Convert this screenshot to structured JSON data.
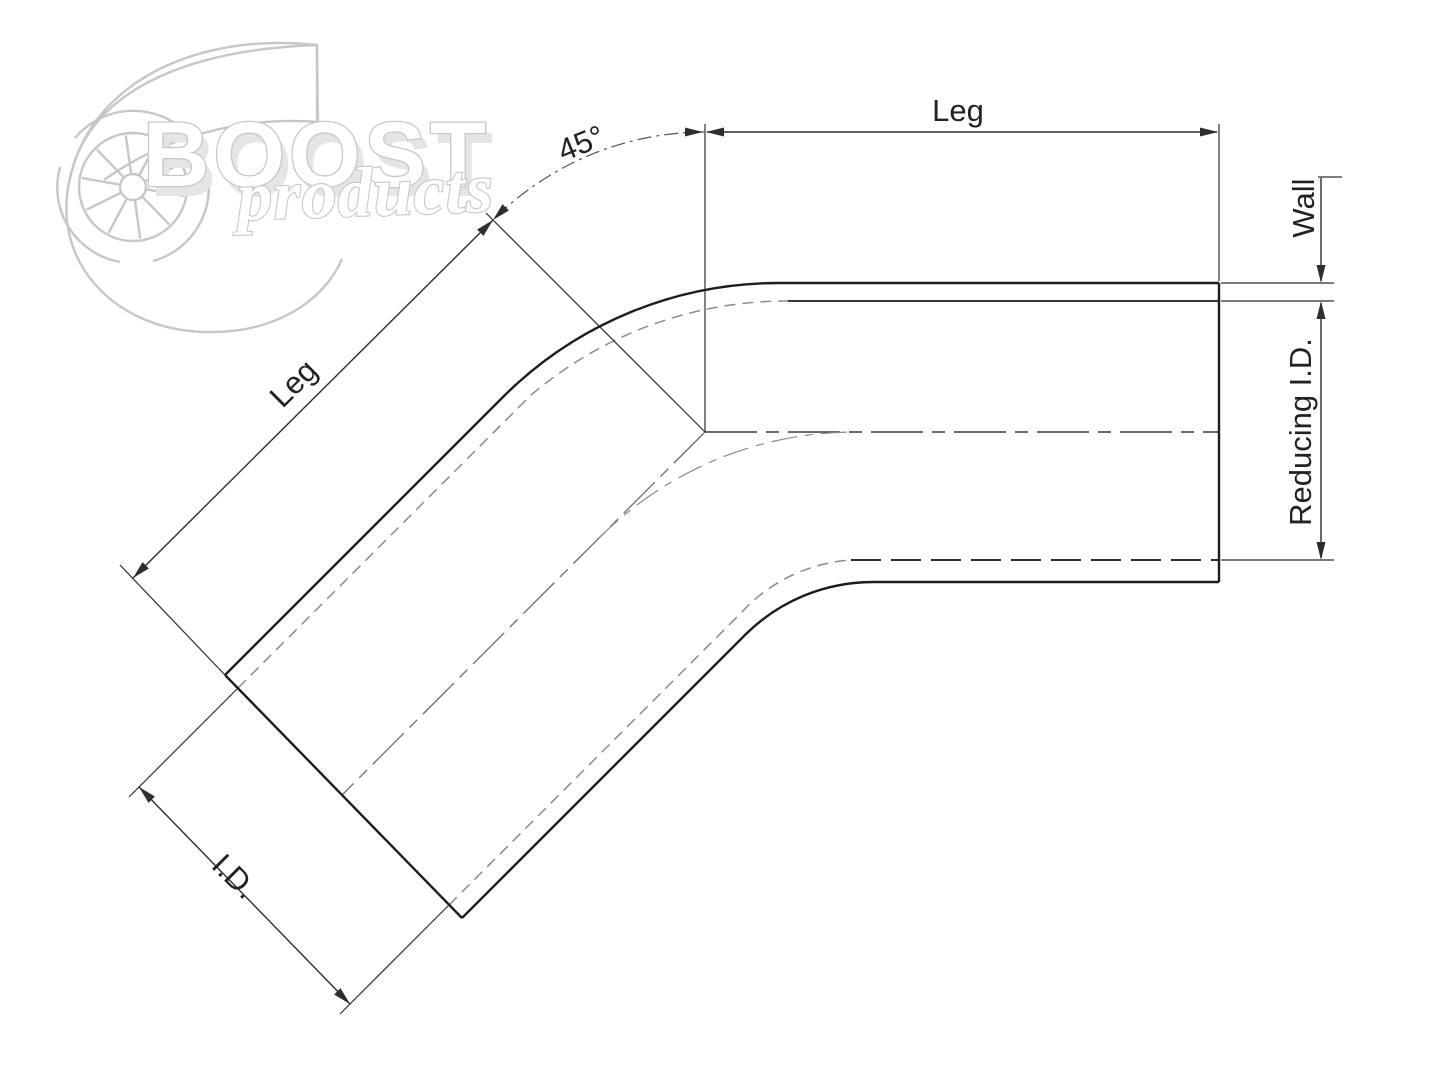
{
  "watermark": {
    "brand": "BOOST",
    "brand_sub": "products"
  },
  "labels": {
    "top_leg": "Leg",
    "angle": "45°",
    "wall": "Wall",
    "reducing_id": "Reducing I.D.",
    "diagonal_leg": "Leg",
    "inner_diameter": "I.D."
  },
  "colors": {
    "background": "#ffffff",
    "line": "#1d1d1d",
    "dim": "#2e2e2e",
    "hidden": "#8b8b8b",
    "watermark": "#c7c7c7"
  }
}
